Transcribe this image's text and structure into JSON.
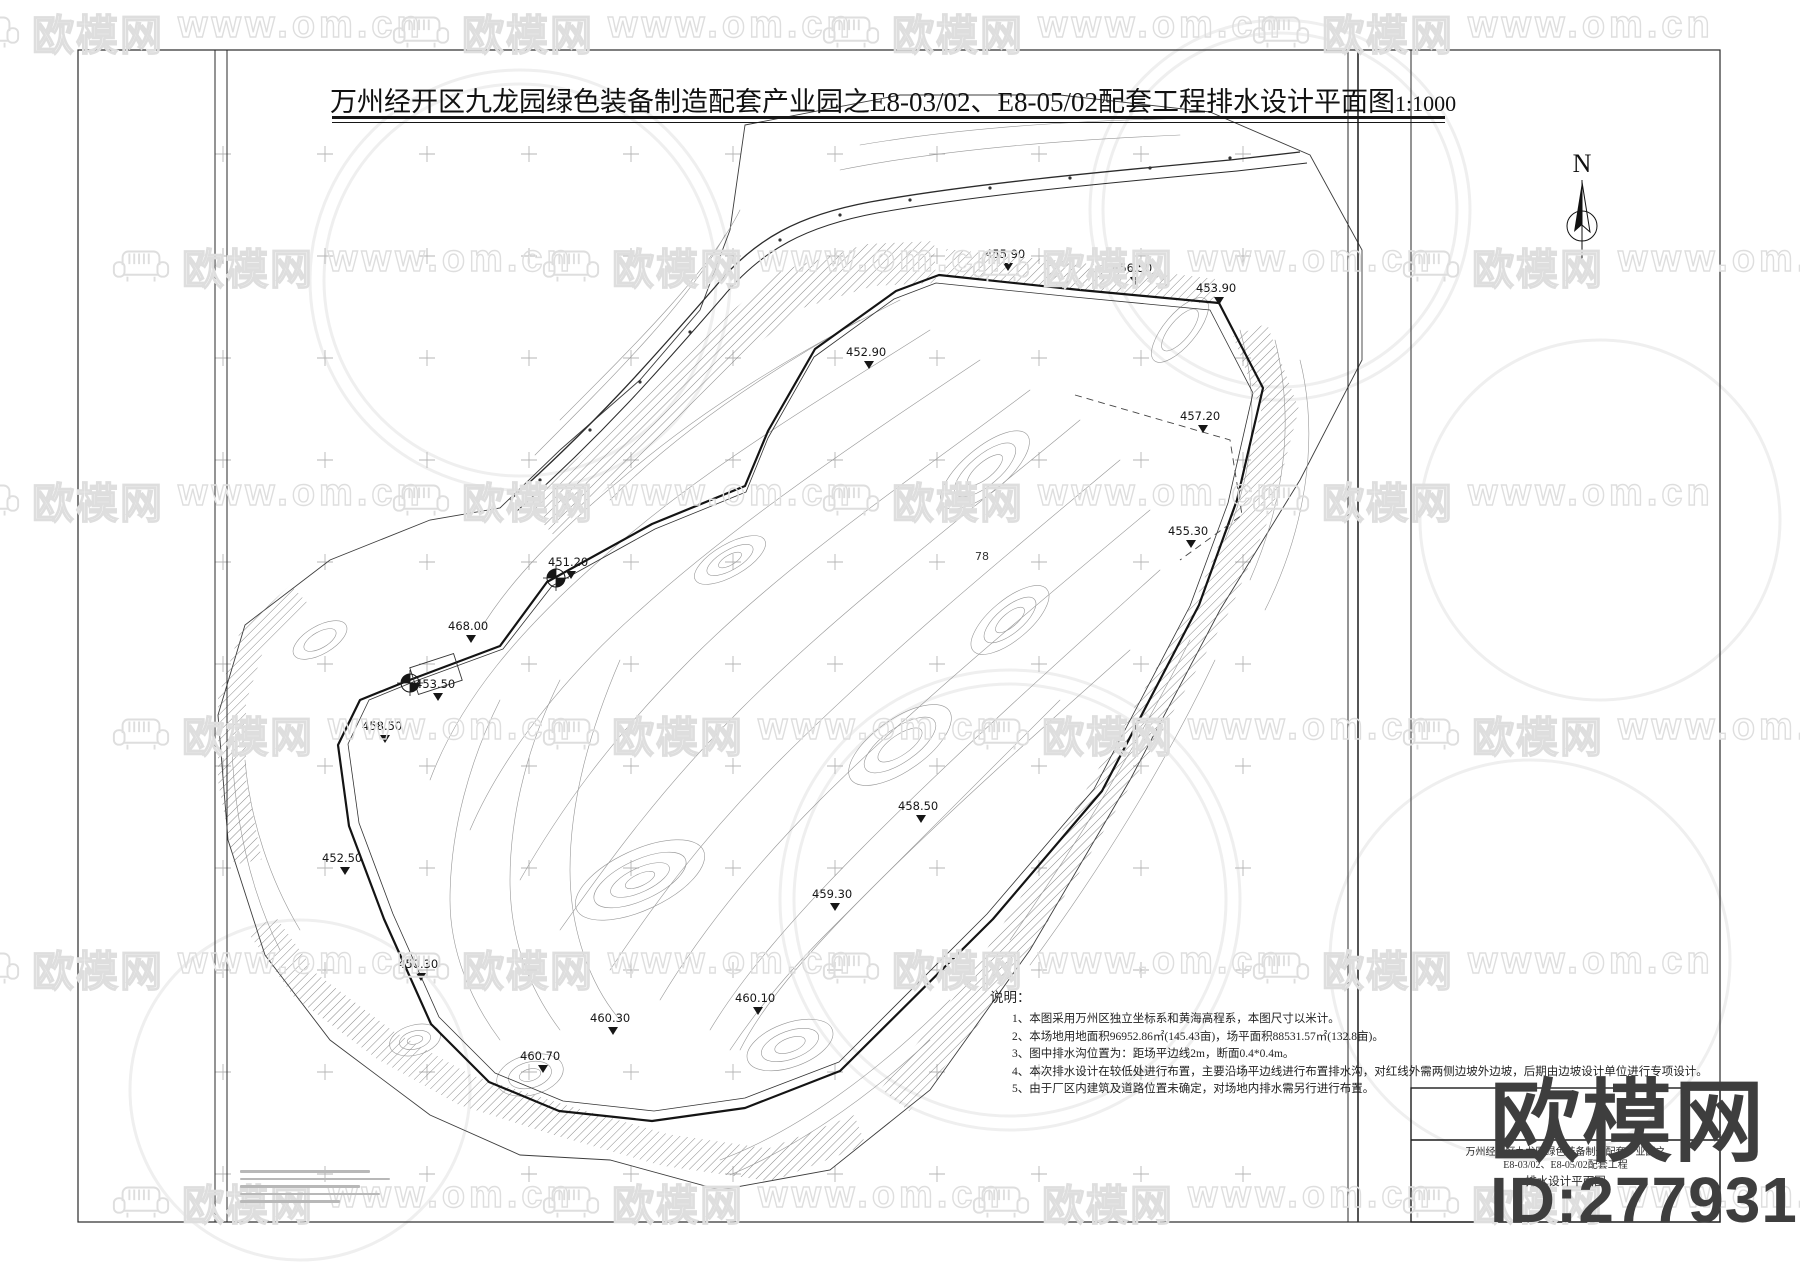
{
  "title": {
    "main": "万州经开区九龙园绿色装备制造配套产业园之E8-03/02、E8-05/02配套工程排水设计平面图",
    "scale": "1:1000"
  },
  "north": {
    "label": "N"
  },
  "notes": {
    "heading": "说明：",
    "items": [
      "1、本图采用万州区独立坐标系和黄海高程系，本图尺寸以米计。",
      "2、本场地用地面积96952.86㎡(145.43亩)，场平面积88531.57㎡(132.8亩)。",
      "3、图中排水沟位置为：距场平边线2m，断面0.4*0.4m。",
      "4、本次排水设计在较低处进行布置，主要沿场平边线进行布置排水沟，对红线外需两侧边坡外边坡，后期由边坡设计单位进行专项设计。",
      "5、由于厂区内建筑及道路位置未确定，对场地内排水需另行进行布置。"
    ]
  },
  "title_block": {
    "line1": "万州经开区九龙园绿色装备制造配套产业园之",
    "line2": "E8-03/02、E8-05/02配套工程",
    "line3": "排水设计平面图"
  },
  "watermark": {
    "logo_text": "欧模网",
    "url_text": "www.om.cn",
    "big_logo_text": "欧模网",
    "id_text": "ID:2779310",
    "grid": {
      "rows": 6,
      "cols": 4,
      "x0": -40,
      "y0": 2,
      "dx": 430,
      "dy": 234,
      "stagger": 150,
      "pair_gap": 218
    }
  },
  "plan": {
    "spot_elevations": [
      {
        "v": "455.90",
        "x": 985,
        "y": 258
      },
      {
        "v": "456.50",
        "x": 1112,
        "y": 272
      },
      {
        "v": "453.90",
        "x": 1196,
        "y": 292
      },
      {
        "v": "452.90",
        "x": 846,
        "y": 356
      },
      {
        "v": "457.20",
        "x": 1180,
        "y": 420
      },
      {
        "v": "455.30",
        "x": 1168,
        "y": 535
      },
      {
        "v": "468.00",
        "x": 448,
        "y": 630
      },
      {
        "v": "453.50",
        "x": 415,
        "y": 688
      },
      {
        "v": "458.50",
        "x": 362,
        "y": 730
      },
      {
        "v": "452.50",
        "x": 322,
        "y": 862
      },
      {
        "v": "450.30",
        "x": 398,
        "y": 968
      },
      {
        "v": "460.30",
        "x": 590,
        "y": 1022
      },
      {
        "v": "460.70",
        "x": 520,
        "y": 1060
      },
      {
        "v": "460.10",
        "x": 735,
        "y": 1002
      },
      {
        "v": "458.50",
        "x": 898,
        "y": 810
      },
      {
        "v": "459.30",
        "x": 812,
        "y": 898
      },
      {
        "v": "451.20",
        "x": 548,
        "y": 566
      }
    ],
    "misc_labels": [
      {
        "v": "78",
        "x": 975,
        "y": 560
      }
    ],
    "symbols": [
      {
        "x": 410,
        "y": 683
      },
      {
        "x": 556,
        "y": 578
      }
    ],
    "grid_crosses": {
      "x0": 223,
      "y0": 154,
      "dx": 102,
      "dy": 102,
      "nx": 11,
      "ny": 11
    }
  },
  "colors": {
    "line": "#1c1c1c",
    "contour": "#979797",
    "hatch": "#6f6f6f",
    "grid_cross": "#b5b5b5",
    "watermark": "#dedede",
    "brand_dark": "#3e3e3e"
  }
}
